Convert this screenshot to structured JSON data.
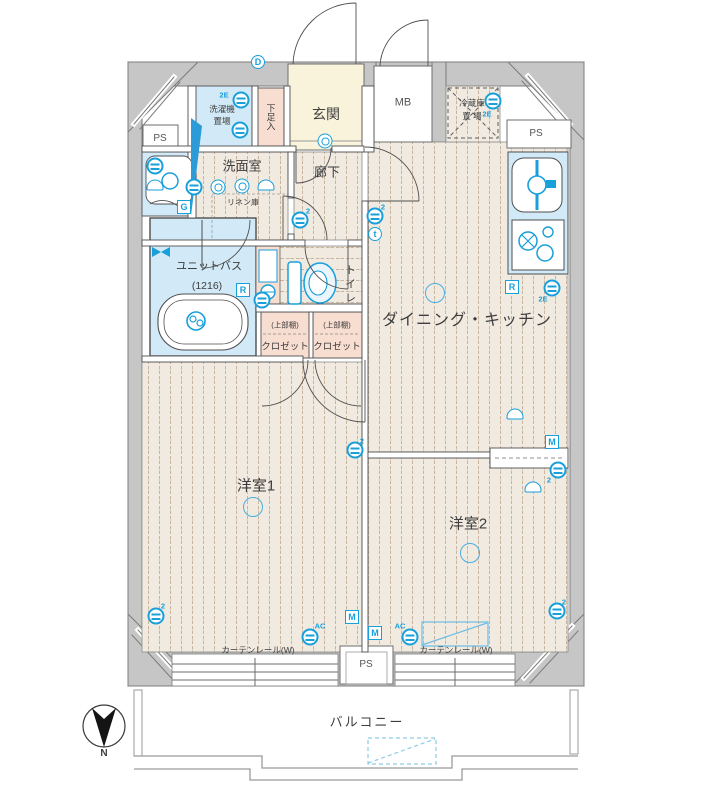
{
  "colors": {
    "fixture_blue": "#199fd9",
    "wall_gray": "#c6c6c6",
    "wall_edge": "#7c7c7c",
    "floor_beige": "#f1eae1",
    "floor_line": "#c9b59d",
    "wet_blue": "#d2eaf7",
    "entry_cream": "#f8f3da",
    "closet_pink": "#f8ddd1",
    "balcony_line": "#9a9a9a"
  },
  "labels": {
    "ps_left": "PS",
    "ps_top_right": "PS",
    "ps_bottom": "PS",
    "mb": "MB",
    "entrance": "玄関",
    "shoe_box": "下足入",
    "washer_line1": "洗濯機",
    "washer_line2": "置場",
    "fridge_line1": "冷蔵庫",
    "fridge_line2": "置 場",
    "washroom": "洗面室",
    "hallway": "廊下",
    "linen": "リネン庫",
    "unit_bath": "ユニットバス",
    "unit_bath_size": "(1216)",
    "toilet": "トイレ",
    "closet_upper": "(上部棚)",
    "closet": "クロゼット",
    "dining_kitchen": "ダイニング・キッチン",
    "room1": "洋室1",
    "room2": "洋室2",
    "curtain_rail": "カーテンレール(W)",
    "balcony": "バルコニー",
    "compass_north": "N"
  },
  "fixtures": [
    {
      "type": "dcircle",
      "label": "D",
      "x": 258,
      "y": 62
    },
    {
      "type": "tag",
      "label": "2E",
      "x": 224,
      "y": 95
    },
    {
      "type": "outlet",
      "x": 241,
      "y": 100
    },
    {
      "type": "outlet",
      "x": 240,
      "y": 130
    },
    {
      "type": "switch",
      "x": 325,
      "y": 141
    },
    {
      "type": "outlet",
      "x": 155,
      "y": 166
    },
    {
      "type": "tv",
      "x": 155,
      "y": 185
    },
    {
      "type": "badge",
      "label": "G",
      "x": 184,
      "y": 207
    },
    {
      "type": "outlet",
      "x": 194,
      "y": 187
    },
    {
      "type": "switch",
      "x": 218,
      "y": 187
    },
    {
      "type": "switch",
      "x": 242,
      "y": 186
    },
    {
      "type": "tv",
      "x": 266,
      "y": 185
    },
    {
      "type": "tag",
      "label": "2",
      "x": 308,
      "y": 211
    },
    {
      "type": "outlet",
      "x": 300,
      "y": 220
    },
    {
      "type": "tag",
      "label": "2",
      "x": 383,
      "y": 207
    },
    {
      "type": "outlet",
      "x": 375,
      "y": 216
    },
    {
      "type": "dcircle",
      "label": "t",
      "x": 375,
      "y": 234
    },
    {
      "type": "outlet",
      "x": 262,
      "y": 300
    },
    {
      "type": "badge",
      "label": "R",
      "x": 243,
      "y": 290
    },
    {
      "type": "light",
      "x": 435,
      "y": 293
    },
    {
      "type": "badge",
      "label": "R",
      "x": 512,
      "y": 287
    },
    {
      "type": "outlet",
      "x": 552,
      "y": 288
    },
    {
      "type": "tag",
      "label": "2E",
      "x": 543,
      "y": 299
    },
    {
      "type": "outlet",
      "x": 493,
      "y": 101
    },
    {
      "type": "tag",
      "label": "2E",
      "x": 487,
      "y": 114
    },
    {
      "type": "tv",
      "x": 515,
      "y": 414
    },
    {
      "type": "badge",
      "label": "M",
      "x": 552,
      "y": 442
    },
    {
      "type": "outlet",
      "x": 558,
      "y": 470
    },
    {
      "type": "tag",
      "label": "2",
      "x": 549,
      "y": 480
    },
    {
      "type": "outlet",
      "x": 355,
      "y": 450
    },
    {
      "type": "tag",
      "label": "2",
      "x": 362,
      "y": 441
    },
    {
      "type": "light",
      "x": 253,
      "y": 507
    },
    {
      "type": "light",
      "x": 470,
      "y": 553
    },
    {
      "type": "tv",
      "x": 533,
      "y": 487
    },
    {
      "type": "outlet",
      "x": 156,
      "y": 616
    },
    {
      "type": "tag",
      "label": "2",
      "x": 163,
      "y": 606
    },
    {
      "type": "badge",
      "label": "M",
      "x": 352,
      "y": 617
    },
    {
      "type": "badge",
      "label": "M",
      "x": 375,
      "y": 633
    },
    {
      "type": "outlet",
      "x": 310,
      "y": 637
    },
    {
      "type": "tag",
      "label": "AC",
      "x": 320,
      "y": 626
    },
    {
      "type": "outlet",
      "x": 410,
      "y": 637
    },
    {
      "type": "tag",
      "label": "AC",
      "x": 400,
      "y": 626
    },
    {
      "type": "outlet",
      "x": 557,
      "y": 611
    },
    {
      "type": "tag",
      "label": "2",
      "x": 564,
      "y": 602
    }
  ]
}
